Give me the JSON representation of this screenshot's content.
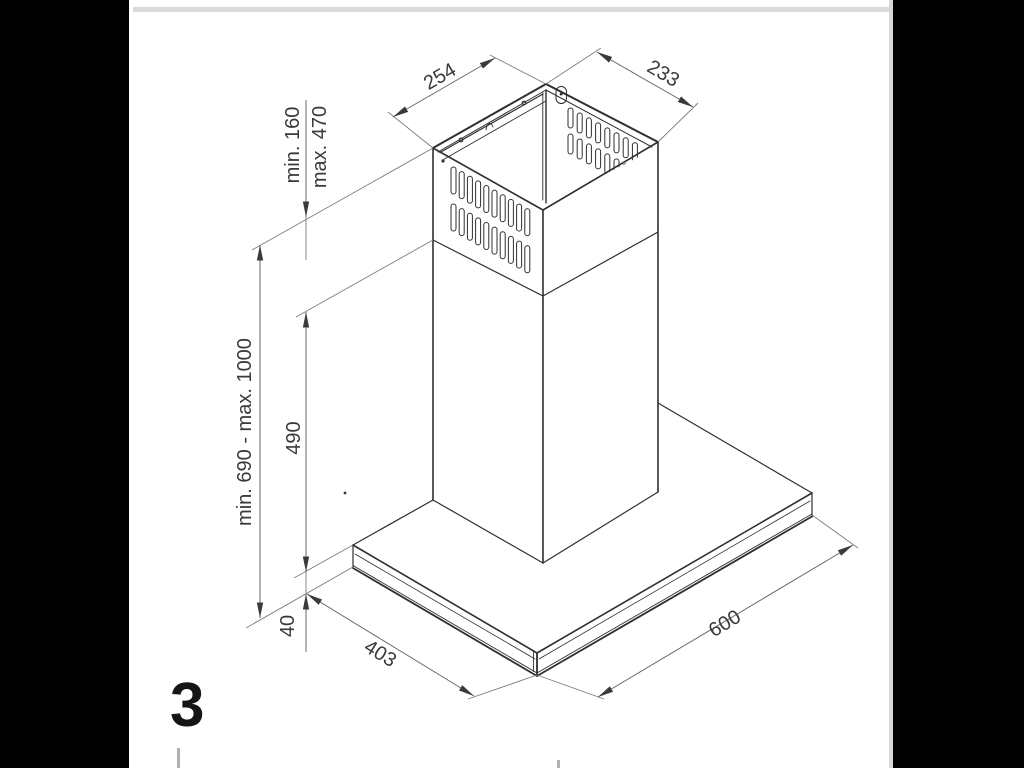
{
  "page": {
    "figure_number": "3"
  },
  "dimensions": {
    "top_depth": "254",
    "top_width": "233",
    "flue_min": "min. 160",
    "flue_max": "max. 470",
    "total_height": "min. 690 - max. 1000",
    "lower_flue_height": "490",
    "canopy_thickness": "40",
    "canopy_depth": "403",
    "canopy_width": "600"
  }
}
